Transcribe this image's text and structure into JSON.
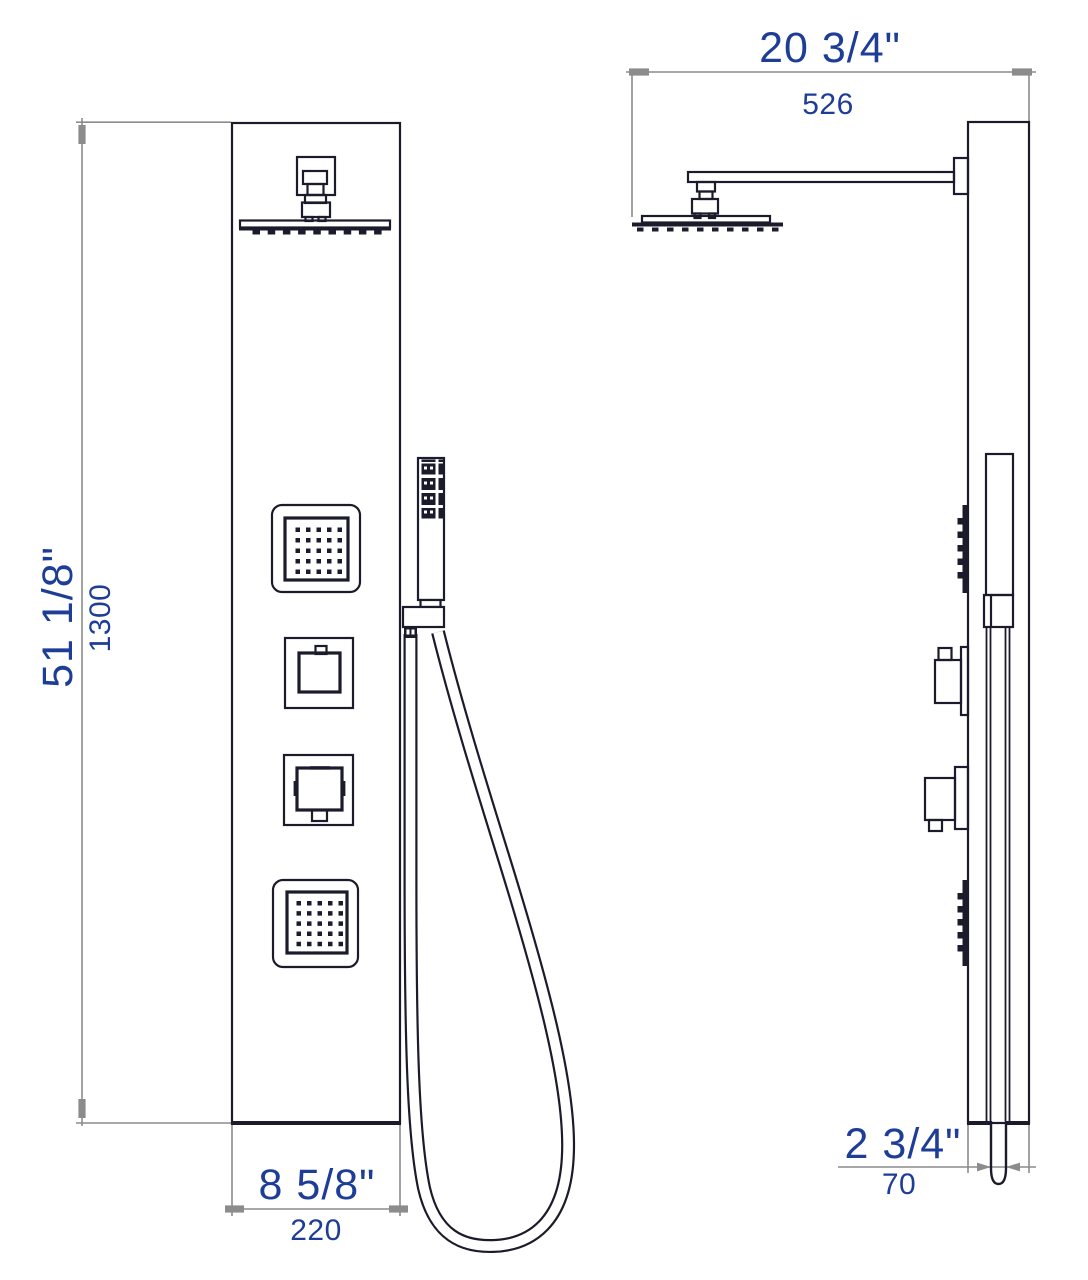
{
  "drawing": {
    "subject": "shower-panel-dimensional-drawing",
    "views": {
      "left": "front-view",
      "right": "side-view"
    }
  },
  "dimensions": {
    "overall_height": {
      "imperial": "51 1/8\"",
      "metric": "1300"
    },
    "panel_width": {
      "imperial": "8 5/8\"",
      "metric": "220"
    },
    "head_projection": {
      "imperial": "20 3/4\"",
      "metric": "526"
    },
    "panel_depth": {
      "imperial": "2 3/4\"",
      "metric": "70"
    }
  },
  "colors": {
    "artwork_line": "#1b1b2b",
    "dimension_line": "#8c8c8c",
    "dimension_text": "#1e3d96",
    "background": "#ffffff"
  }
}
